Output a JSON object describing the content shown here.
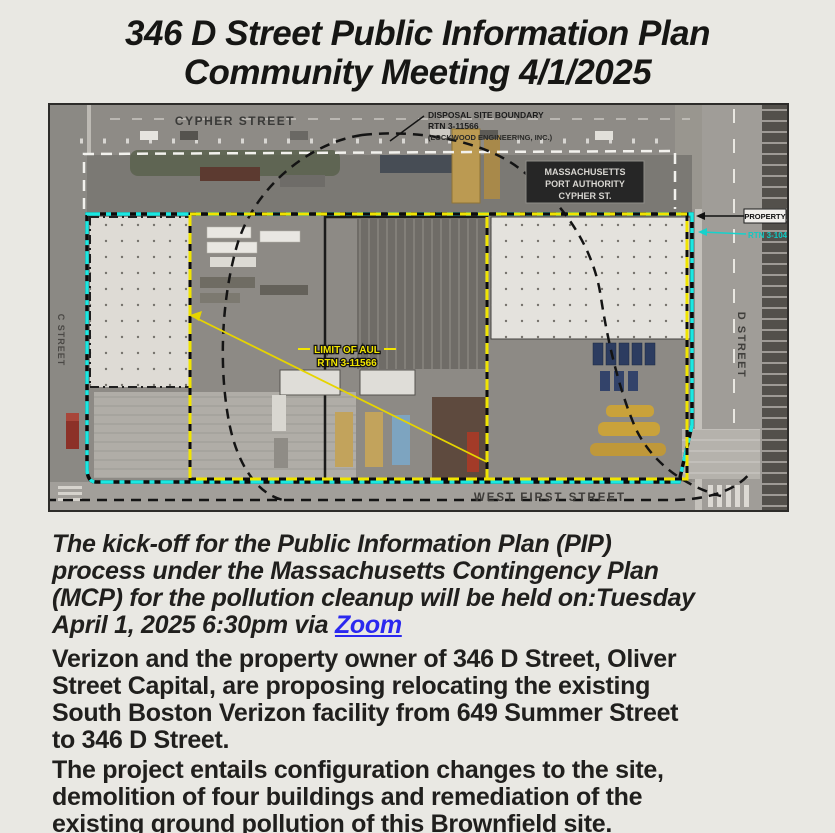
{
  "title": {
    "line1": "346 D Street Public Information Plan",
    "line2": "Community Meeting 4/1/2025"
  },
  "map": {
    "labels": {
      "cypher_street": "CYPHER STREET",
      "west_first_street": "WEST FIRST STREET",
      "d_street": "D STREET",
      "c_street": "C STREET",
      "disposal": {
        "line1": "DISPOSAL SITE BOUNDARY",
        "line2": "RTN 3-11566",
        "line3": "(LOCKWOOD ENGINEERING, INC.)"
      },
      "massport": {
        "line1": "MASSACHUSETTS",
        "line2": "PORT AUTHORITY",
        "line3": "CYPHER ST."
      },
      "property": "PROPERTY",
      "property_rtn": "RTN 3-10451",
      "aul": {
        "line1": "LIMIT OF AUL",
        "line2": "RTN 3-11566"
      }
    },
    "colors": {
      "property_line": "#1ae8e2",
      "aul_line": "#f0e400",
      "disposal_line": "#141414",
      "street_boundary": "#f2f1ed",
      "aul_text": "#f2e500",
      "rtn_text": "#10c9c3"
    }
  },
  "paragraphs": {
    "kickoff": {
      "lines": [
        "The kick-off for the Public Information Plan (PIP)",
        "process under the Massachusetts Contingency Plan",
        "(MCP) for the pollution cleanup will be held on:Tuesday"
      ],
      "last_line_prefix": "April 1, 2025 6:30pm via ",
      "link_label": "Zoom"
    },
    "verizon": {
      "lines": [
        "Verizon and the property owner of 346 D Street, Oliver",
        "Street Capital, are proposing relocating the existing",
        "South Boston Verizon facility from 649 Summer Street",
        "to 346 D Street."
      ]
    },
    "project": {
      "lines": [
        "The project entails configuration changes to the site,",
        "demolition of four buildings and remediation of the",
        "existing ground pollution of this Brownfield site."
      ]
    }
  }
}
